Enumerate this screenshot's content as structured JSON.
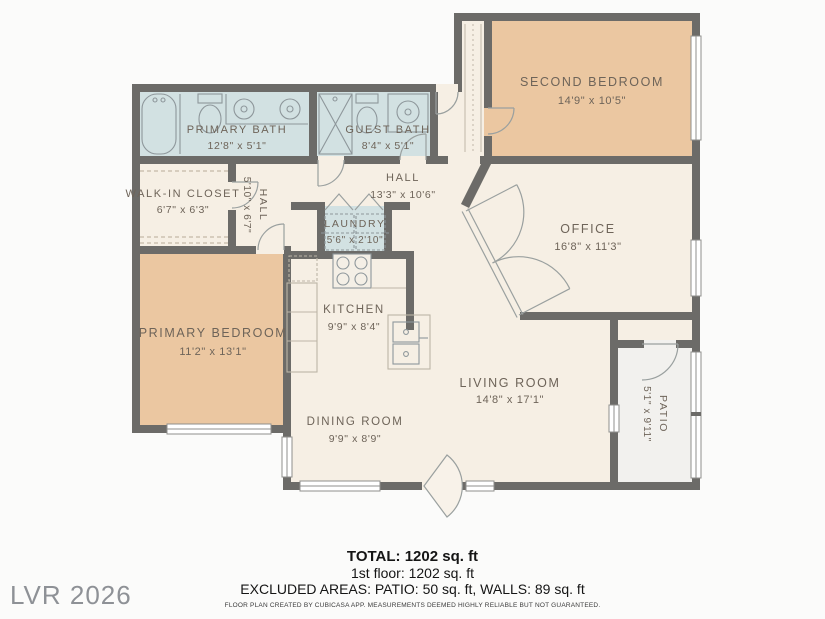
{
  "watermark": "LVR 2026",
  "footer": {
    "total": "TOTAL: 1202 sq. ft",
    "floor": "1st floor: 1202 sq. ft",
    "excluded": "EXCLUDED AREAS: PATIO: 50 sq. ft, WALLS: 89 sq. ft",
    "disclaimer": "FLOOR PLAN CREATED BY CUBICASA APP. MEASUREMENTS DEEMED HIGHLY RELIABLE BUT NOT GUARANTEED."
  },
  "colors": {
    "wall": "#6c6b68",
    "room_cream": "#f6efe4",
    "room_tan": "#ebc7a1",
    "room_blue": "#d2e1e2",
    "patio": "#f2f1ee",
    "label_text": "#6e6459"
  },
  "rooms": [
    {
      "id": "primary-bath",
      "name": "PRIMARY BATH",
      "dims": "12'8\" x 5'1\""
    },
    {
      "id": "guest-bath",
      "name": "GUEST BATH",
      "dims": "8'4\" x 5'1\""
    },
    {
      "id": "second-bedroom",
      "name": "SECOND BEDROOM",
      "dims": "14'9\" x 10'5\""
    },
    {
      "id": "walk-in-closet",
      "name": "WALK-IN CLOSET",
      "dims": "6'7\" x 6'3\""
    },
    {
      "id": "hall-small",
      "name": "HALL",
      "dims": "5'10\" x 6'7\""
    },
    {
      "id": "hall",
      "name": "HALL",
      "dims": "13'3\" x 10'6\""
    },
    {
      "id": "laundry",
      "name": "LAUNDRY",
      "dims": "5'6\" x 2'10\""
    },
    {
      "id": "office",
      "name": "OFFICE",
      "dims": "16'8\" x 11'3\""
    },
    {
      "id": "kitchen",
      "name": "KITCHEN",
      "dims": "9'9\" x 8'4\""
    },
    {
      "id": "primary-bedroom",
      "name": "PRIMARY BEDROOM",
      "dims": "11'2\" x 13'1\""
    },
    {
      "id": "living-room",
      "name": "LIVING ROOM",
      "dims": "14'8\" x 17'1\""
    },
    {
      "id": "dining-room",
      "name": "DINING ROOM",
      "dims": "9'9\" x 8'9\""
    },
    {
      "id": "patio",
      "name": "PATIO",
      "dims": "5'1\" x 9'11\""
    }
  ]
}
